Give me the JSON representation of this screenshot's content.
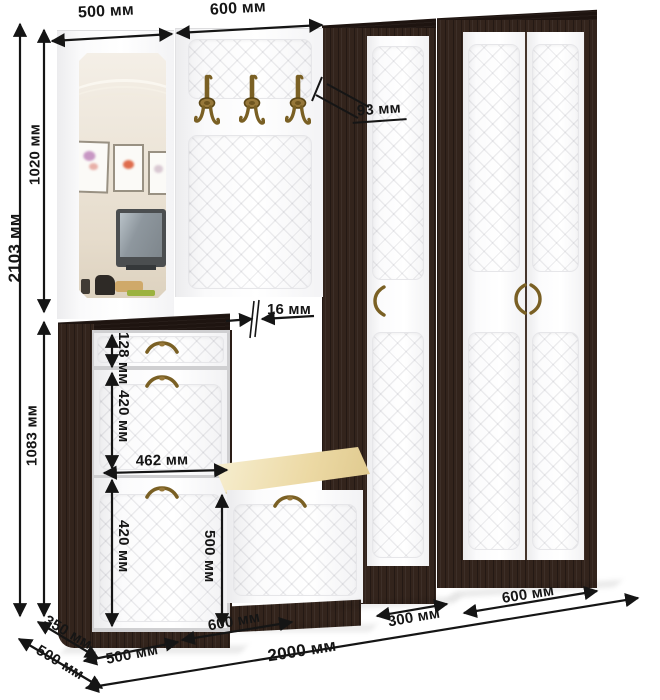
{
  "diagram": {
    "type": "furniture-dimension-diagram",
    "subject": "Hallway furniture set: mirror panel, coat-hook panel, shoe cabinet, bench, narrow wardrobe, wide wardrobe",
    "units": "мм",
    "colors": {
      "wenge_dark": "#33241c",
      "front_white": "#fcfcfd",
      "cushion_cream": "#ecd9a4",
      "hardware_bronze": "#7a6024",
      "dimension_ink": "#151515",
      "background": "#ffffff"
    },
    "hardware_icons": [
      "coat-hook-icon",
      "bow-handle-icon"
    ],
    "dimensions": {
      "mirror_section_width": "500 мм",
      "hook_section_width": "600 мм",
      "total_height": "2103 мм",
      "upper_section_height": "1020 мм",
      "lower_section_height": "1083 мм",
      "side_depth": "93 мм",
      "panel_thickness": "16 мм",
      "drawer_front_height": "128 мм",
      "upper_flap_height": "420 мм",
      "front_inner_width": "462 мм",
      "lower_flap_height": "420 мм",
      "bench_front_height": "500 мм",
      "bench_depth": "350 мм",
      "cabinet_depth": "500 мм",
      "shoe_cabinet_width": "500 мм",
      "bench_width": "600 мм",
      "narrow_wardrobe_width": "300 мм",
      "wide_wardrobe_width": "600 мм",
      "total_width": "2000 мм"
    }
  }
}
